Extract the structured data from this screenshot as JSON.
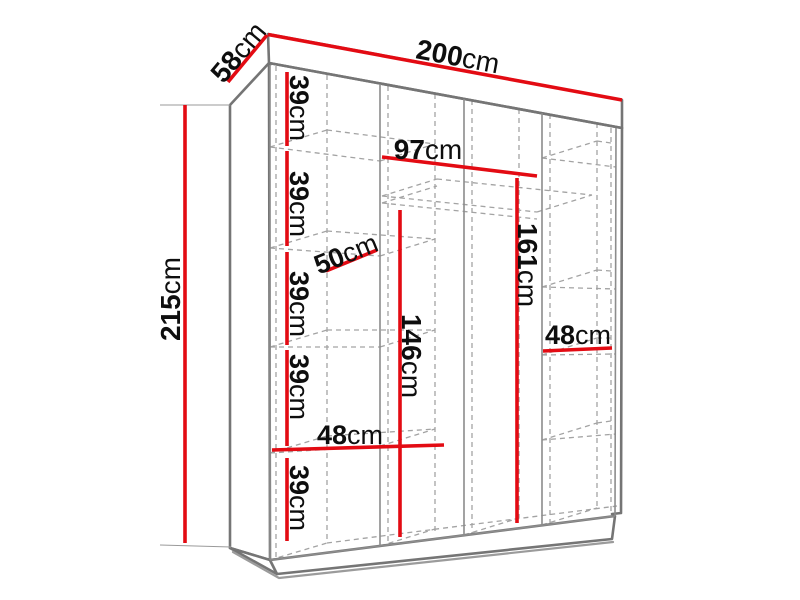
{
  "title": "Wardrobe dimension diagram",
  "unit": "cm",
  "colors": {
    "dimension": "#E30B13",
    "outline": "#757575",
    "hidden": "#A3A3A3",
    "text": "#0E0E0E"
  },
  "overall_dimensions": {
    "width_cm": 200,
    "depth_cm": 58,
    "height_cm": 215
  },
  "labels": {
    "width": {
      "value": "200",
      "unit": "cm"
    },
    "depth": {
      "value": "58",
      "unit": "cm"
    },
    "height": {
      "value": "215",
      "unit": "cm"
    },
    "shelf_gap_1": {
      "value": "39",
      "unit": "cm"
    },
    "shelf_gap_2": {
      "value": "39",
      "unit": "cm"
    },
    "shelf_gap_3": {
      "value": "39",
      "unit": "cm"
    },
    "shelf_gap_4": {
      "value": "39",
      "unit": "cm"
    },
    "shelf_gap_5": {
      "value": "39",
      "unit": "cm"
    },
    "shelf_depth": {
      "value": "50",
      "unit": "cm"
    },
    "left_section_width": {
      "value": "48",
      "unit": "cm"
    },
    "middle_section_width": {
      "value": "97",
      "unit": "cm"
    },
    "hanging_height_middle": {
      "value": "146",
      "unit": "cm"
    },
    "hanging_height_right": {
      "value": "161",
      "unit": "cm"
    },
    "right_section_width": {
      "value": "48",
      "unit": "cm"
    }
  }
}
